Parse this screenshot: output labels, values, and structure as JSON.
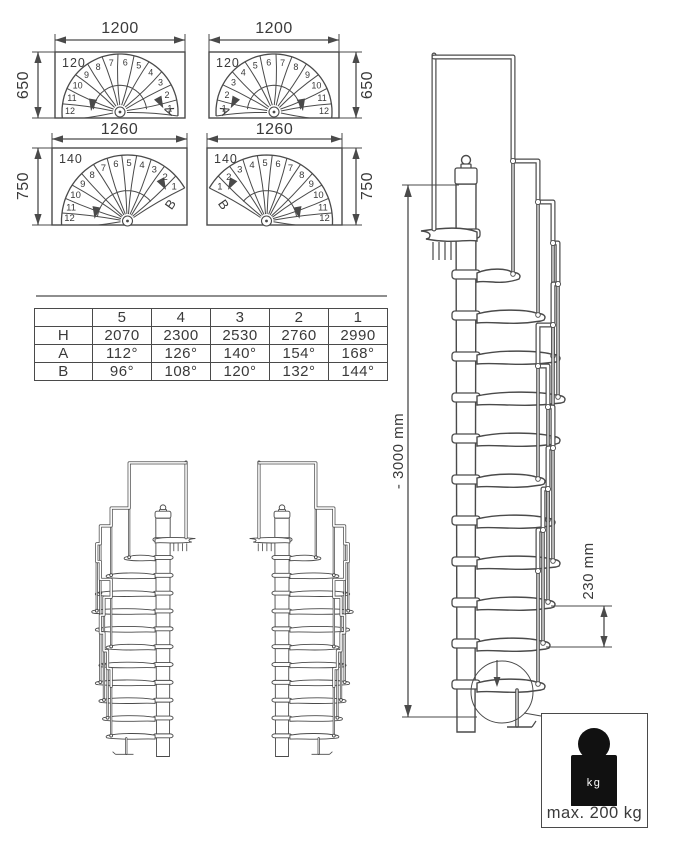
{
  "sheet": {
    "background": "#ffffff",
    "line_color": "#4a4a4a",
    "text_color": "#3a3a3a"
  },
  "plan_views": {
    "step_numbers": [
      "1",
      "2",
      "3",
      "4",
      "5",
      "6",
      "7",
      "8",
      "9",
      "10",
      "11",
      "12"
    ],
    "fans": [
      {
        "name": "plan-650-left",
        "dim_top": "1200",
        "dim_side": "650",
        "corner_label": "120",
        "letter": "A",
        "mirrored": false,
        "row": 0
      },
      {
        "name": "plan-650-right",
        "dim_top": "1200",
        "dim_side": "650",
        "corner_label": "120",
        "letter": "A",
        "mirrored": true,
        "row": 0
      },
      {
        "name": "plan-750-left",
        "dim_top": "1260",
        "dim_side": "750",
        "corner_label": "140",
        "letter": "B",
        "mirrored": false,
        "row": 1
      },
      {
        "name": "plan-750-right",
        "dim_top": "1260",
        "dim_side": "750",
        "corner_label": "140",
        "letter": "B",
        "mirrored": true,
        "row": 1
      }
    ]
  },
  "spec_table": {
    "col_headers": [
      "",
      "5",
      "4",
      "3",
      "2",
      "1"
    ],
    "rows": [
      {
        "label": "H",
        "values": [
          "2070",
          "2300",
          "2530",
          "2760",
          "2990"
        ]
      },
      {
        "label": "A",
        "values": [
          "112°",
          "126°",
          "140°",
          "154°",
          "168°"
        ]
      },
      {
        "label": "B",
        "values": [
          "96°",
          "108°",
          "120°",
          "132°",
          "144°"
        ]
      }
    ]
  },
  "elevation": {
    "height_label": "- 3000 mm",
    "riser_label": "230 mm"
  },
  "load_box": {
    "icon_label": "kg",
    "label": "max. 200 kg"
  }
}
